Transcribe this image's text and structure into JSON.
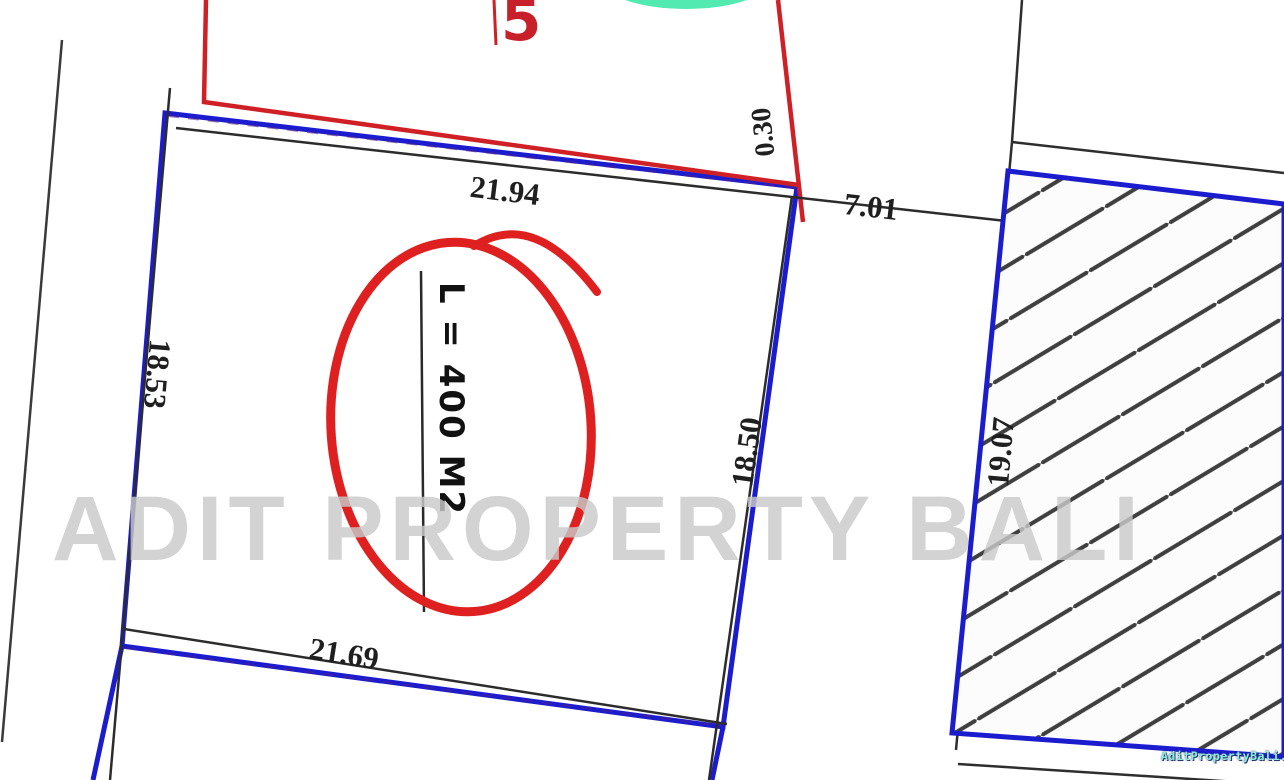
{
  "title": "Land plot survey drawing",
  "plot": {
    "number": "5",
    "area_label": "L = 400 M2"
  },
  "dimensions": {
    "top": "21.94",
    "top_right": "7.01",
    "left": "18.53",
    "right": "18.50",
    "bottom": "21.69",
    "right_neighbor": "19.07",
    "top_offset": "0.30"
  },
  "watermark": {
    "main": "ADIT PROPERTY BALI",
    "site": "AditPropertyBali.com"
  },
  "colors": {
    "parcel_outline_blue": "#1c1ccf",
    "red_boundary": "#cf2026",
    "annotation_red": "#df2020",
    "dimension_line_black": "#2c2c2c",
    "green_mark": "#35e6a5",
    "watermark_gray": "#c9c9c9",
    "site_text_teal": "#8aeedd",
    "background": "#ffffff"
  }
}
